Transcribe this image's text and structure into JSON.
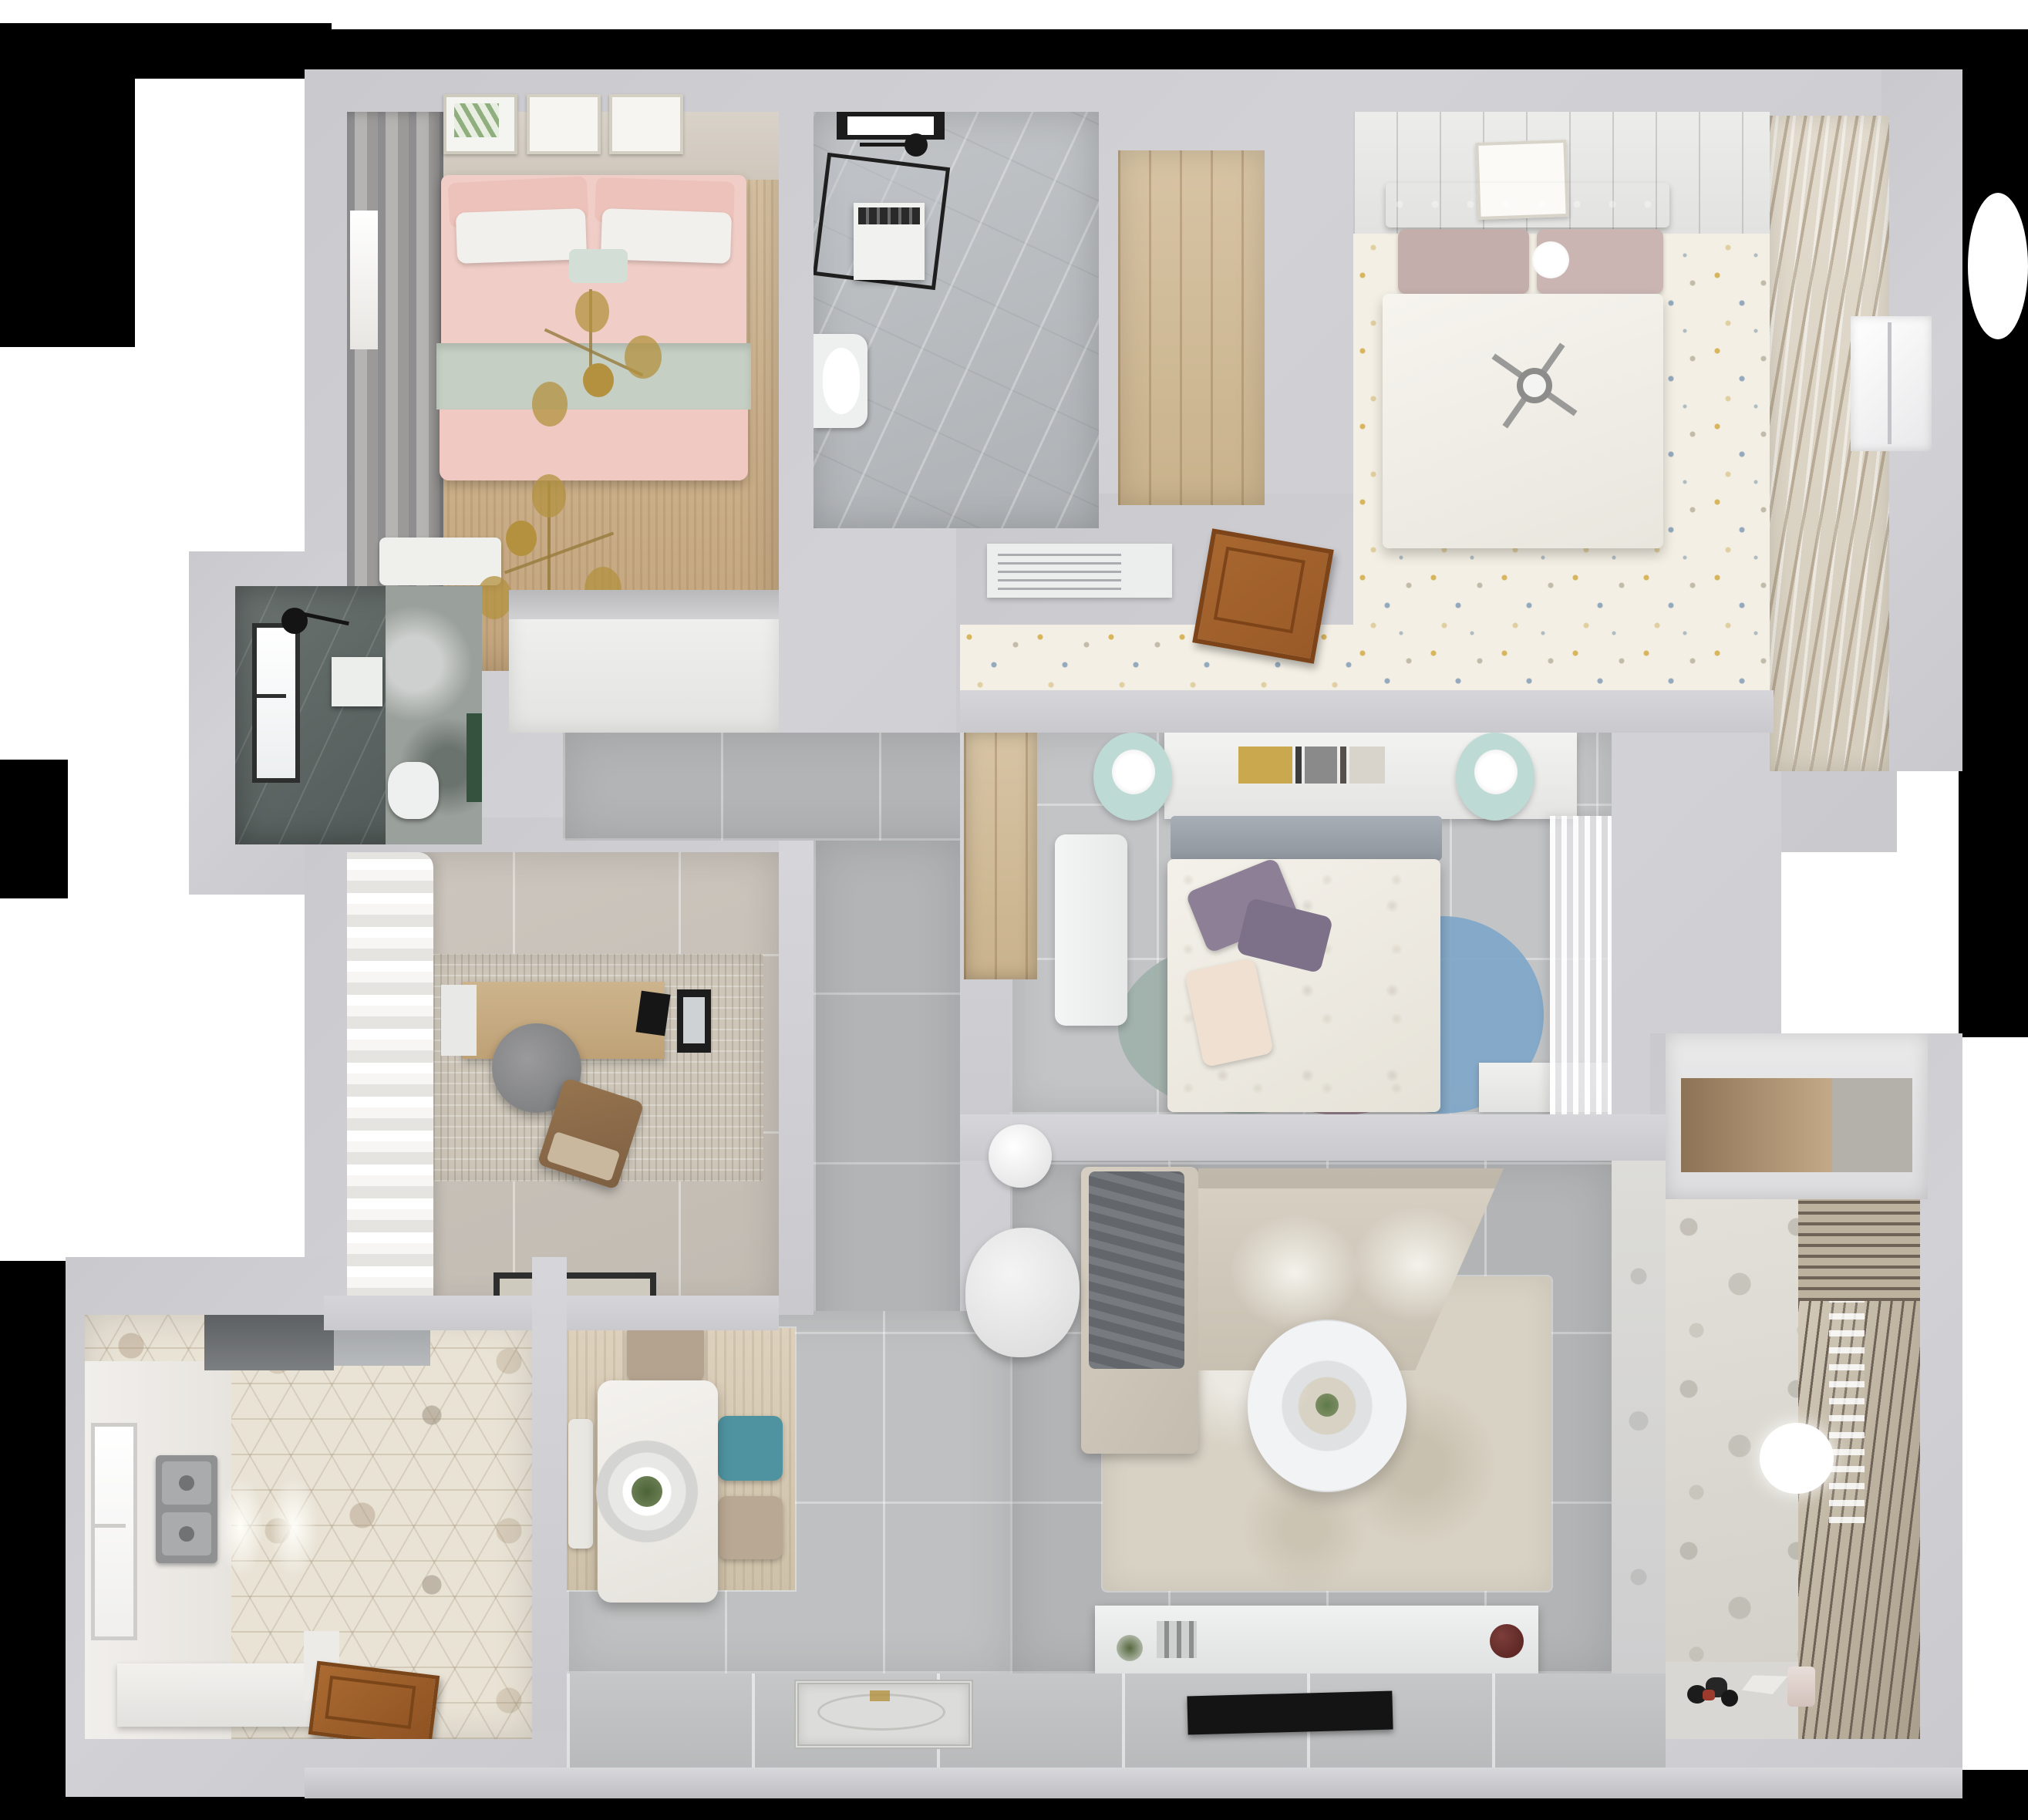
{
  "title": "Top-down 3D render of a three-bedroom apartment floor plan",
  "background": {
    "canvas": "#ffffff",
    "mask": "#000000"
  },
  "palette": {
    "canvas": "#ffffff",
    "mask": "#000000",
    "wall": "#c9c9ce",
    "tile": "#b3b4b6",
    "tileLight": "#bfc0c1",
    "confetti": "#f3efe4",
    "kitchenHex": "#e9e3d6",
    "kitchenWhite": "#efedea",
    "rugLiving": "#d8d2c4",
    "studyRugC": "#cdc6b9",
    "sofa": "#d0c9bc",
    "throw": "#6f7377",
    "pink": "#f0cdc6",
    "sage": "#c5cfc3",
    "duvetWhite": "#f1efe9",
    "headboardTR": "#97a1b0",
    "pillowMauve": "#c3aeac",
    "pillowPurple": "#8c7f96",
    "mint": "#bedad4",
    "rugBlue": "#7ea6c8",
    "rugMauve": "#9c8491",
    "rugSage": "#9fb0a8",
    "teal": "#4f93a0",
    "chairBeige": "#b4a38f",
    "doorBrown": "#9a5a28",
    "gold": "#b3913f",
    "steel": "#a9abad",
    "tv": "#141414",
    "greenPlant": "#5e7a4a",
    "greenAccent": "#35523f",
    "nicheWood": "#a98e6d"
  },
  "rooms": [
    {
      "id": "bedroom-top-left",
      "name": "Master bedroom",
      "furniture": [
        "double-bed-pink-bedding",
        "sage-throw-blanket",
        "white-pillows",
        "gold-branch-chandelier",
        "window-curtains",
        "wall-art-frames",
        "white-bench"
      ]
    },
    {
      "id": "bathroom-top",
      "name": "Main bathroom",
      "furniture": [
        "glass-shower-enclosure",
        "black-framed-window",
        "rain-shower-head",
        "washing-machine",
        "toilet"
      ]
    },
    {
      "id": "closet-top",
      "name": "Walk-in closet / hallway nook",
      "furniture": [
        "wood-plank-floor"
      ]
    },
    {
      "id": "bedroom-top-right",
      "name": "Guest bedroom",
      "furniture": [
        "double-bed-white-duvet",
        "tufted-gray-headboard",
        "mauve-pillows",
        "ceiling-fan-light",
        "wall-art-frame",
        "slatted-blinds",
        "confetti-carpet",
        "open-wood-door",
        "ac-vent"
      ]
    },
    {
      "id": "ensuite-bathroom",
      "name": "Dark en-suite bathroom",
      "furniture": [
        "window",
        "black-shower-fixture",
        "mirror",
        "toilet",
        "green-accent-wall"
      ]
    },
    {
      "id": "storage-closet",
      "name": "Storage / laundry closet",
      "furniture": [
        "cabinet"
      ]
    },
    {
      "id": "study",
      "name": "Study / home office",
      "furniture": [
        "desk",
        "laptop",
        "office-chair",
        "brown-lounge-chair",
        "textured-rug",
        "white-curtains",
        "door-mat"
      ]
    },
    {
      "id": "kitchen",
      "name": "Kitchen",
      "furniture": [
        "double-sink",
        "window",
        "range-hood",
        "fridge-top",
        "ceiling-lights",
        "l-shaped-counter",
        "hexagon-tile-floor",
        "wood-entry-door"
      ]
    },
    {
      "id": "dining-area",
      "name": "Dining area",
      "furniture": [
        "white-dining-table",
        "pendant-lamp-rings",
        "teal-chair",
        "beige-chairs",
        "white-bench",
        "wood-tone-rug"
      ]
    },
    {
      "id": "bedroom-center",
      "name": "Kids / center bedroom",
      "furniture": [
        "bed-floral-duvet",
        "purple-pillows",
        "headboard-shelf-with-books",
        "potted-plant",
        "mint-round-nightstands",
        "white-lamps",
        "white-desk",
        "overlapping-round-rugs",
        "sheer-curtains",
        "wardrobe-niche",
        "white-cabinet"
      ]
    },
    {
      "id": "living-room",
      "name": "Living room",
      "furniture": [
        "l-shaped-sofa",
        "gray-throw",
        "round-coffee-table",
        "white-armchair",
        "side-stool",
        "area-rug",
        "tv-console",
        "flat-tv",
        "decor-plant",
        "mugs"
      ]
    },
    {
      "id": "balcony",
      "name": "Balcony / utility room",
      "furniture": [
        "louvered-shutters",
        "patterned-tile-wall",
        "ceiling-light",
        "toy-cars",
        "toy-kite",
        "small-bin",
        "wood-storage-niche"
      ]
    },
    {
      "id": "entry",
      "name": "Entry hallway",
      "furniture": [
        "ornate-door-mat",
        "threshold-strip"
      ]
    },
    {
      "id": "hallway",
      "name": "Central hallway",
      "furniture": [
        "gray-tile-floor"
      ]
    }
  ]
}
